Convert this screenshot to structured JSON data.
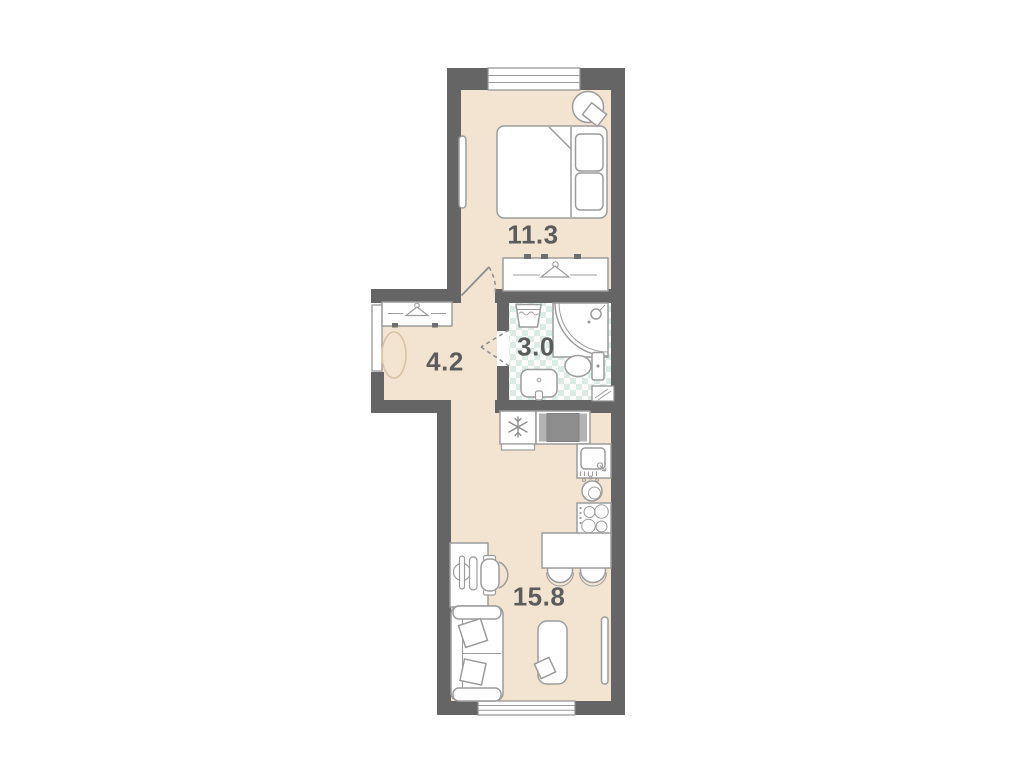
{
  "rooms": [
    {
      "id": "bedroom",
      "area": "11.3"
    },
    {
      "id": "hallway",
      "area": "4.2"
    },
    {
      "id": "bathroom",
      "area": "3.0"
    },
    {
      "id": "kitchen-living",
      "area": "15.8"
    }
  ],
  "colors": {
    "background": "#ffffff",
    "wall": "#656565",
    "floor": "#f2e4d1",
    "bath_tile": "#dbece4",
    "furniture_stroke": "#9c9c9c",
    "label_text": "#5c5c5c",
    "entry_rug_stroke": "#d9c3a3"
  },
  "icons": {
    "hanger": "wardrobe-hanger symbol",
    "snowflake": "fridge symbol",
    "burners": "stove symbol",
    "shower_arc": "corner shower tray"
  },
  "furniture": {
    "bedroom": [
      "double-bed",
      "pillows",
      "bedside-table-lamp",
      "mirror",
      "wardrobe",
      "window"
    ],
    "hallway": [
      "closet",
      "entrance-door",
      "entry-rug"
    ],
    "bathroom": [
      "laundry-basket",
      "corner-shower",
      "toilet",
      "sink",
      "vent-shaft"
    ],
    "kitchen-living": [
      "fridge",
      "washing-machine",
      "kitchen-sink",
      "kettle",
      "stove",
      "dining-table",
      "chairs",
      "desk",
      "desk-chair",
      "sofa",
      "rug",
      "tv",
      "window"
    ]
  }
}
